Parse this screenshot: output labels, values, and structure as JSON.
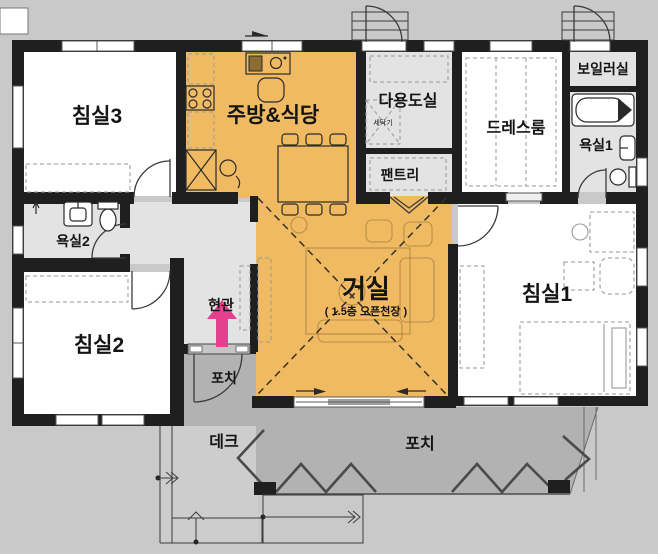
{
  "plan": {
    "labels": {
      "bedroom3": "침실3",
      "kitchen": "주방&식당",
      "utility": "다용도실",
      "washer": "세탁기",
      "pantry": "팬트리",
      "dressroom": "드레스룸",
      "boiler": "보일러실",
      "bath1": "욕실1",
      "bath2": "욕실2",
      "entry": "현관",
      "living": "거실",
      "living_sub": "( 1.5층 오픈천장 )",
      "bedroom1": "침실1",
      "bedroom2": "침실2",
      "porch_small": "포치",
      "porch_large": "포치",
      "deck": "데크"
    },
    "colors": {
      "background": "#c9c9c9",
      "wall": "#1f1f1f",
      "room_white": "#ffffff",
      "room_gray": "#e3e3e3",
      "floor_orange": "#f0ba62",
      "porch": "#b2b2b2",
      "deck": "#cdcdcd",
      "arrow_pink": "#e5408f"
    }
  }
}
